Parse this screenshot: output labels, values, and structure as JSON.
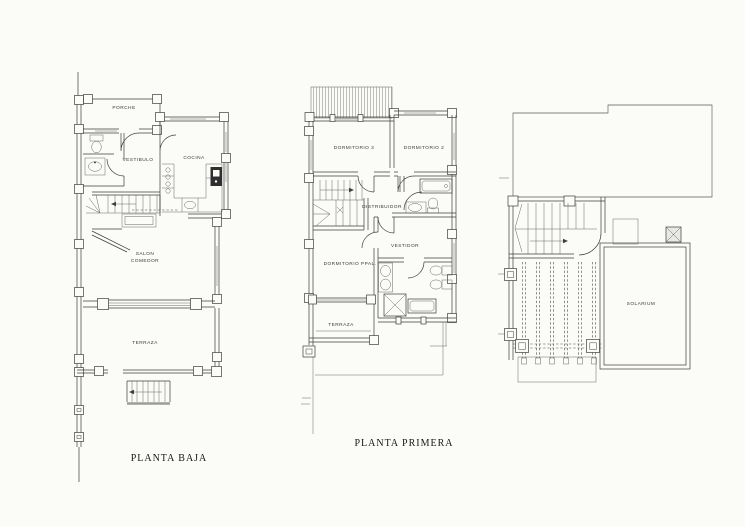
{
  "page": {
    "background": "#fbfbf8",
    "ink": "#3e3e3e"
  },
  "plans": {
    "planta_baja": {
      "caption": "PLANTA BAJA",
      "rooms": {
        "porche": "PORCHE",
        "vestibulo": "VESTIBULO",
        "cocina": "COCINA",
        "salon_line1": "SALON",
        "salon_line2": "COMEDOR",
        "terraza": "TERRAZA"
      }
    },
    "planta_primera": {
      "caption": "PLANTA PRIMERA",
      "rooms": {
        "dormitorio3": "DORMITORIO 3",
        "dormitorio2": "DORMITORIO 2",
        "distribuidor": "DISTRIBUIDOR",
        "vestidor": "VESTIDOR",
        "dormitorio_ppal": "DORMITORIO PPAL.",
        "terraza": "TERRAZA"
      }
    },
    "planta_solarium": {
      "rooms": {
        "solarium": "SOLARIUM"
      }
    }
  }
}
